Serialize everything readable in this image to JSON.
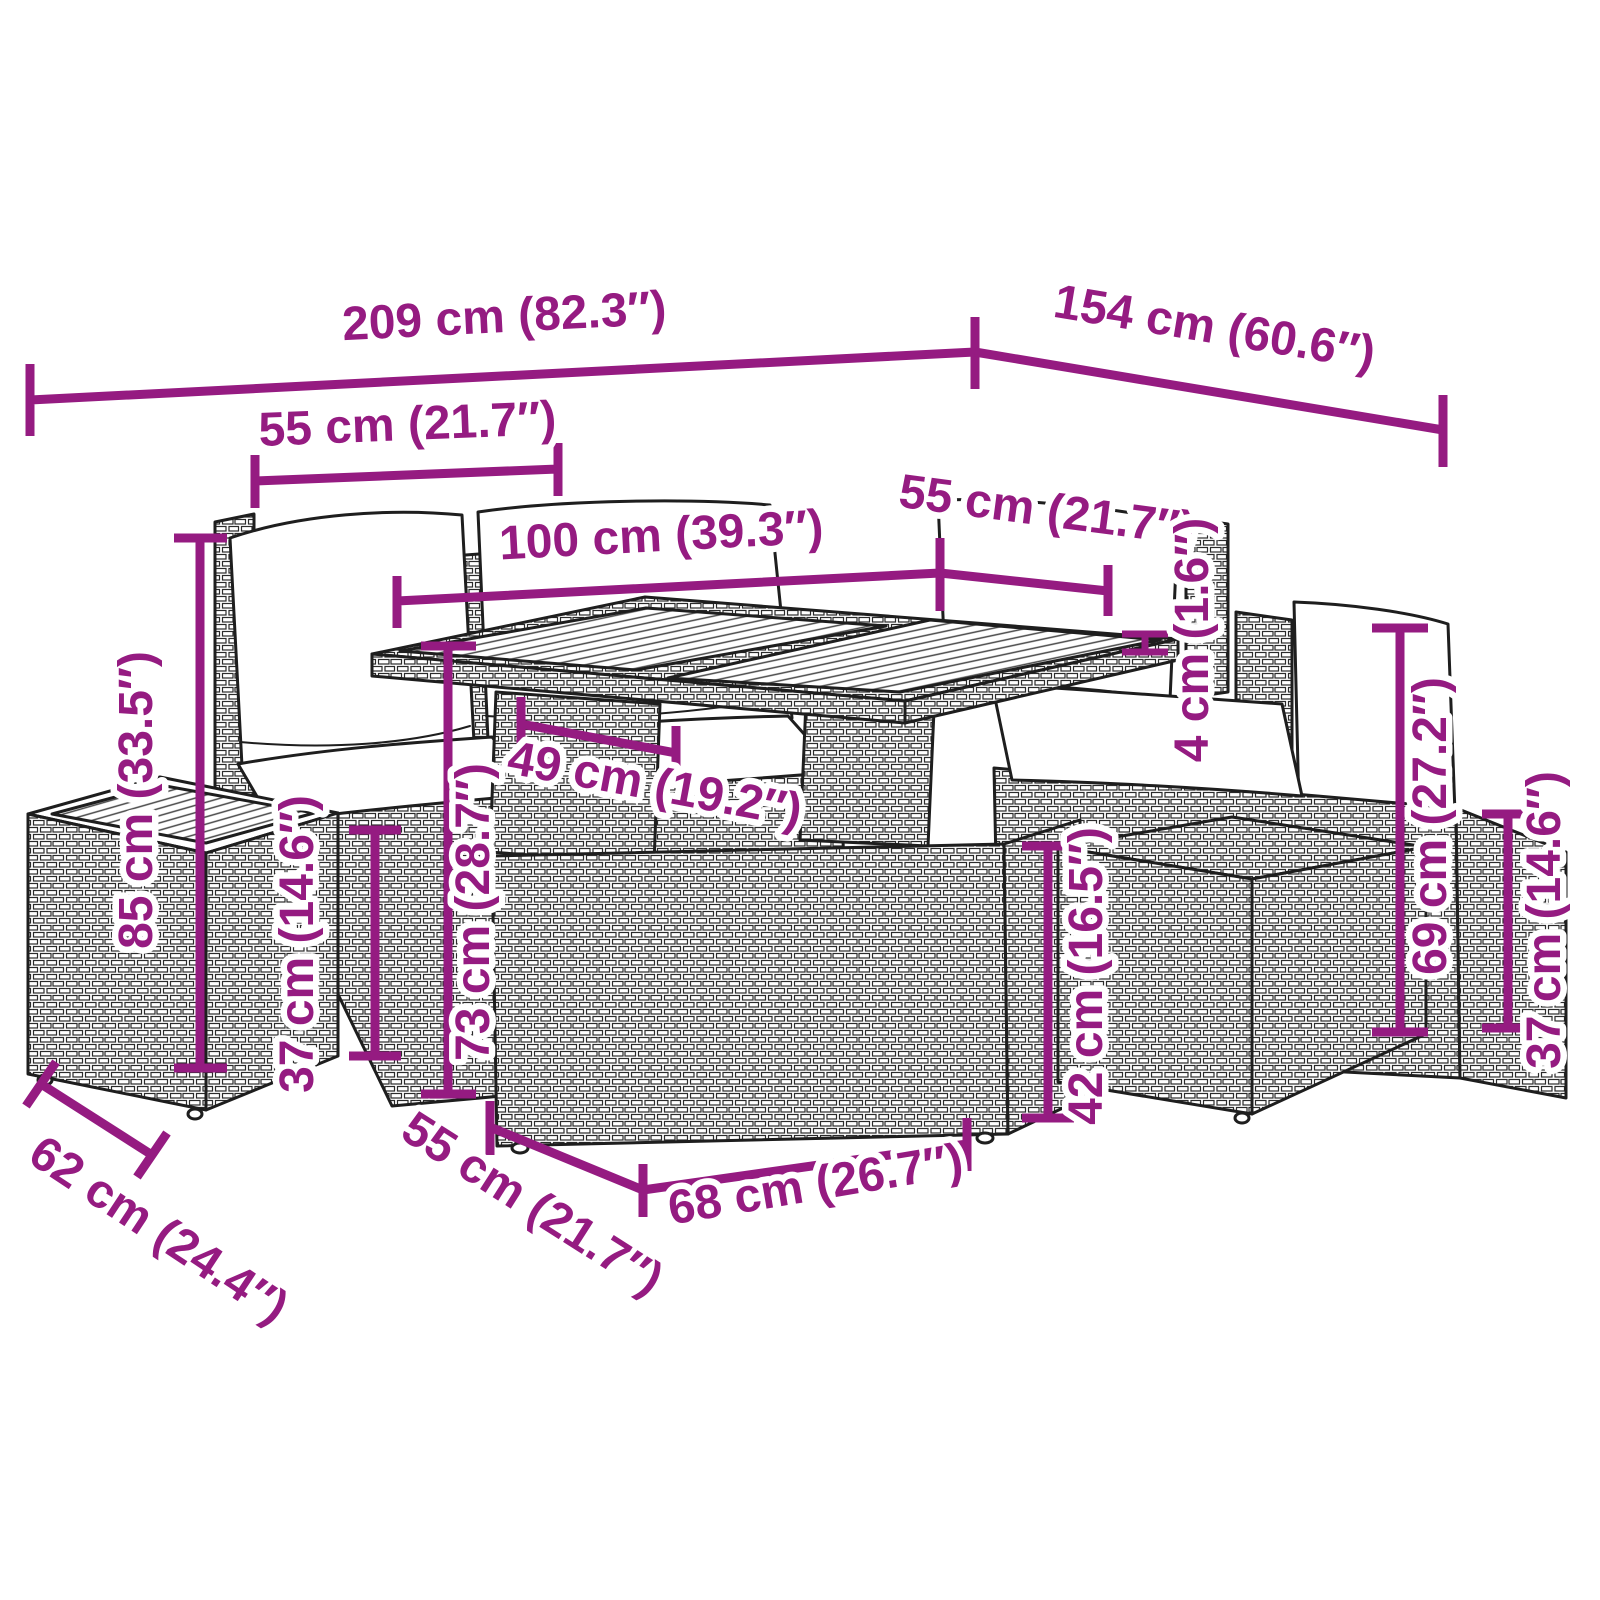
{
  "diagram": {
    "accent_color": "#951B81",
    "dimensions": {
      "top_width": "209 cm (82.3″)",
      "top_depth": "154 cm (60.6″)",
      "left_seat_width": "55 cm (21.7″)",
      "table_length": "100 cm (39.3″)",
      "right_seat_width": "55 cm (21.7″)",
      "tabletop_thickness": "4 cm (1.6″)",
      "total_height": "85 cm (33.5″)",
      "left_seat_height": "37 cm (14.6″)",
      "table_height": "73 cm (28.7″)",
      "table_inner_width": "49 cm (19.2″)",
      "back_height": "69 cm (27.2″)",
      "right_ottoman_height": "42 cm (16.5″)",
      "right_seat_height": "37 cm (14.6″)",
      "ottoman_depth": "62 cm (24.4″)",
      "ottoman_width": "55 cm (21.7″)",
      "table_base_width": "68 cm (26.7″)"
    }
  }
}
